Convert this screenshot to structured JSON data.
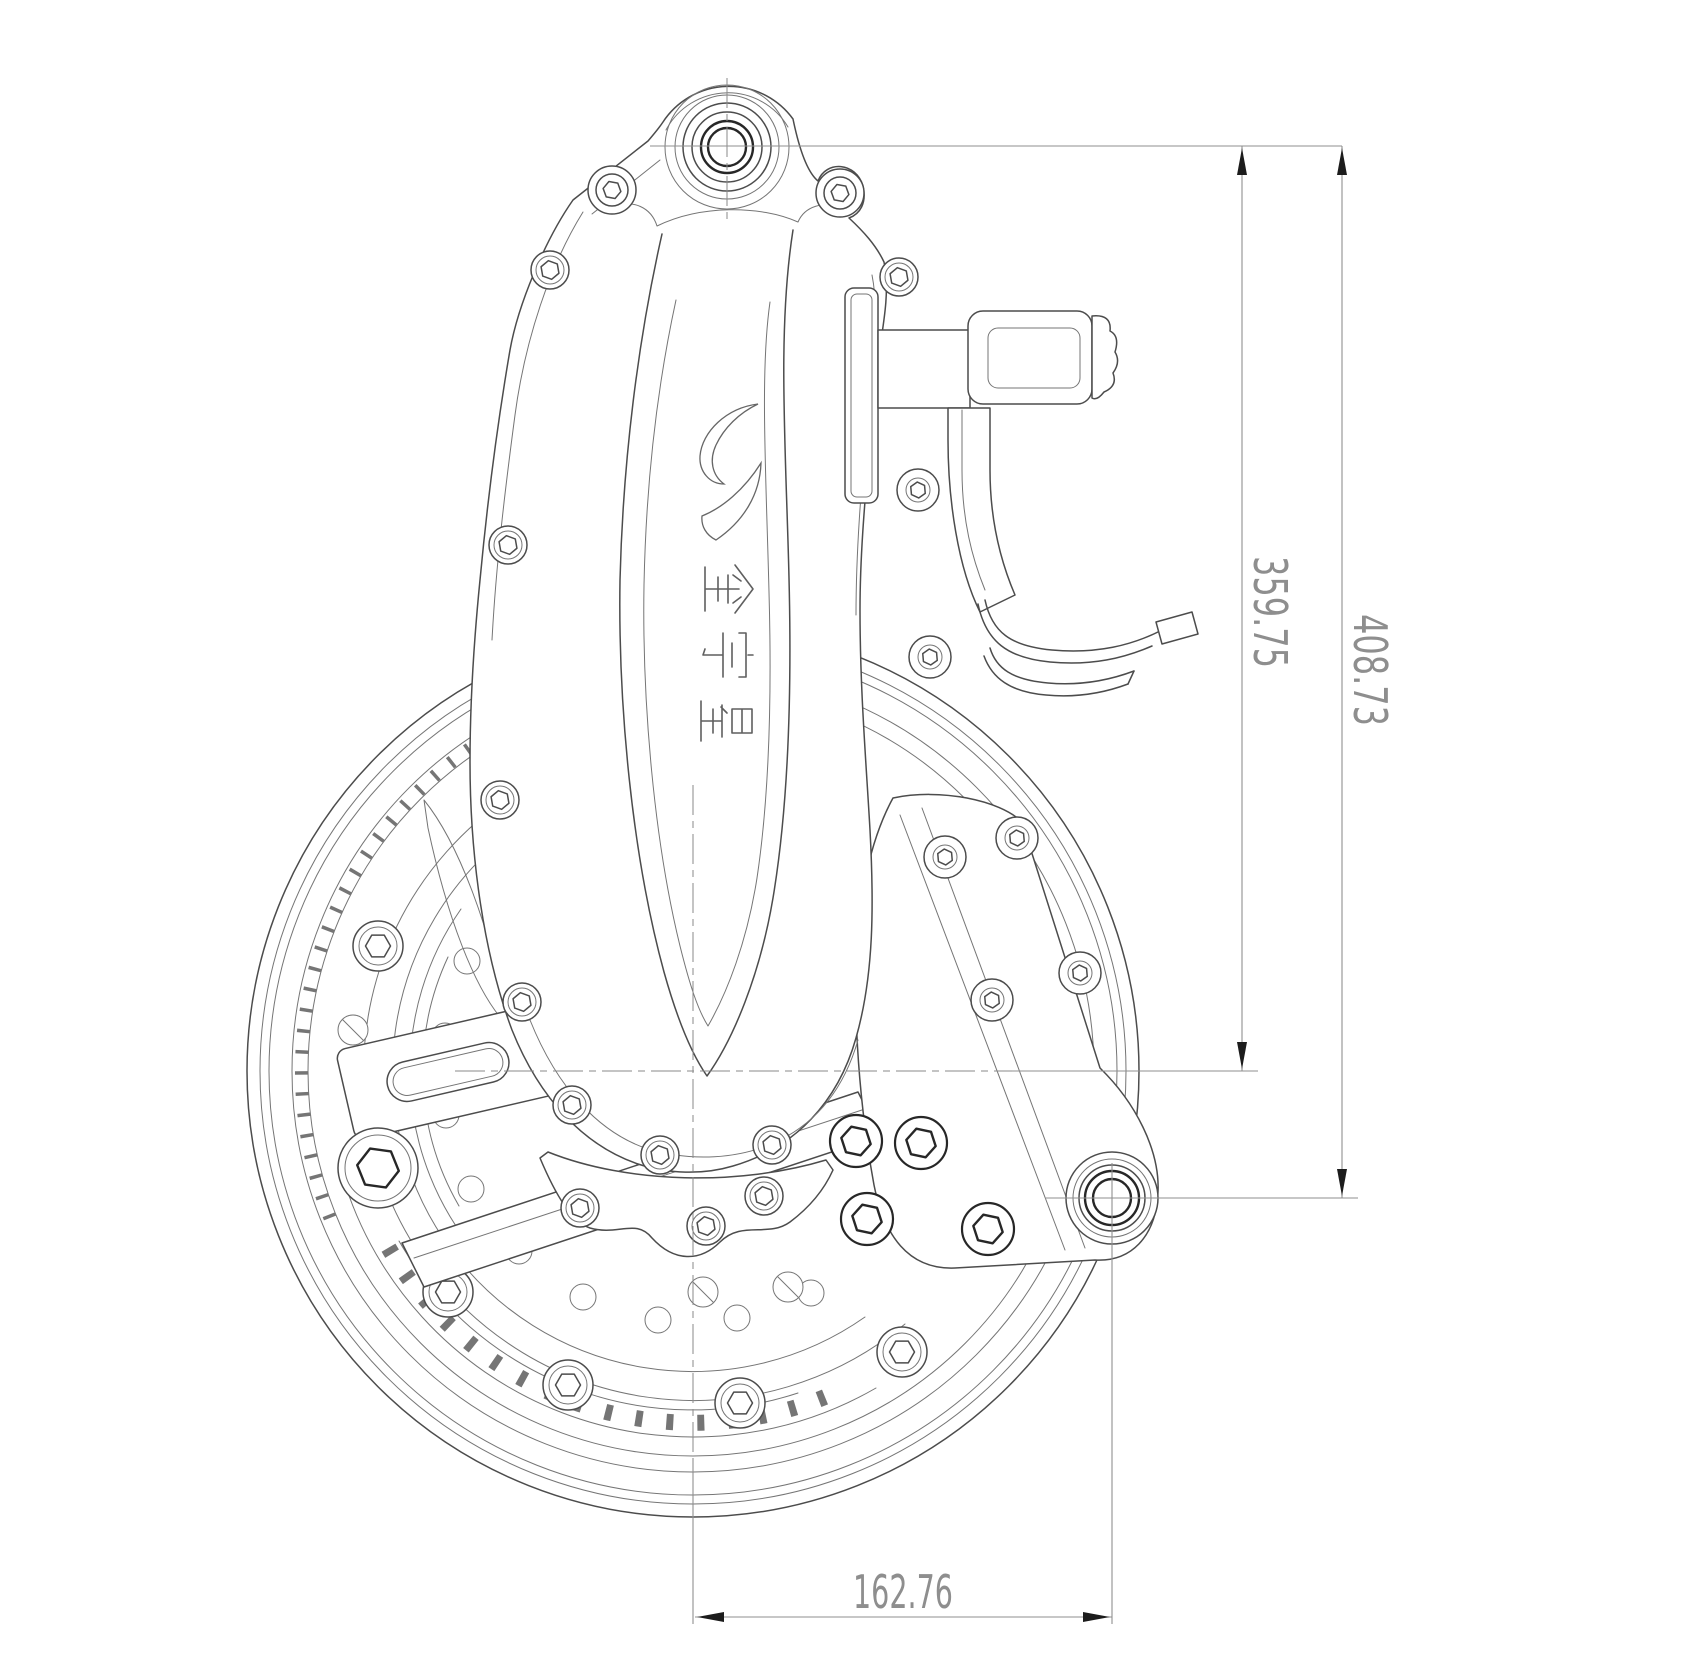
{
  "drawing": {
    "logo": {
      "text": "金宇星",
      "mark": "swoosh-crescent"
    },
    "dimensions": {
      "wheel_center_height": "359.75",
      "overall_height": "408.73",
      "horizontal_offset": "162.76"
    },
    "colors": {
      "background": "#ffffff",
      "part_line": "#4c4c4c",
      "thin_line": "#757575",
      "bold_line": "#272727",
      "dim_line": "#8f8f8f",
      "dim_text": "#8e8e8e",
      "centerline": "#8a8a8a",
      "arrow": "#1c1c1c",
      "logo_line": "#5f5f5f"
    }
  }
}
